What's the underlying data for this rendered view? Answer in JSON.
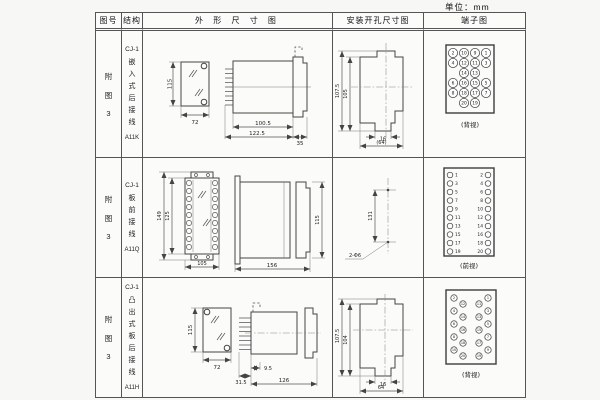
{
  "unit_label": "单位：mm",
  "headers": {
    "figure_no": "图号",
    "structure": "结构",
    "outline": "外 形 尺 寸 图",
    "mounting": "安装开孔尺寸图",
    "terminal": "端子图"
  },
  "rows": [
    {
      "figure_chars": [
        "附",
        "图",
        "3"
      ],
      "model": "CJ-1",
      "type_chars": [
        "嵌",
        "入",
        "式",
        "后",
        "接",
        "线"
      ],
      "code": "A11K",
      "outline": {
        "front_h": "115",
        "front_w": "72",
        "side_l1": "100.5",
        "side_l2": "122.5",
        "side_d": "35"
      },
      "mounting": {
        "outer_h": "107.5",
        "inner_h": "105",
        "slot_w": "16",
        "outer_w": "(64)"
      },
      "terminal_view": "(背视)"
    },
    {
      "figure_chars": [
        "附",
        "图",
        "3"
      ],
      "model": "CJ-1",
      "type_chars": [
        "板",
        "前",
        "接",
        "线"
      ],
      "code": "A11Q",
      "outline": {
        "front_h": "149",
        "front_h2": "125",
        "front_w": "105",
        "side_l": "156",
        "side_h": "115"
      },
      "mounting": {
        "hole_dist": "131",
        "hole_label": "2-Φ6"
      },
      "terminal_view": "(前视)"
    },
    {
      "figure_chars": [
        "附",
        "图",
        "3"
      ],
      "model": "CJ-1",
      "type_chars": [
        "凸",
        "出",
        "式",
        "板",
        "后",
        "接",
        "线"
      ],
      "code": "A11H",
      "outline": {
        "front_h": "115",
        "front_w": "72",
        "pin_len": "31.5",
        "offset": "9.5",
        "side_l": "126"
      },
      "mounting": {
        "outer_h": "107.5",
        "inner_h": "104",
        "slot_w": "16",
        "outer_w": "64"
      },
      "terminal_view": "(背视)"
    }
  ],
  "terminals": {
    "a11k_rows": [
      [
        "2",
        "10",
        "9",
        "1"
      ],
      [
        "4",
        "12",
        "11",
        "3"
      ],
      [
        "14",
        "13"
      ],
      [
        "6",
        "16",
        "15",
        "5"
      ],
      [
        "8",
        "18",
        "17",
        "7"
      ],
      [
        "20",
        "19"
      ]
    ],
    "a11q_left": [
      "1",
      "3",
      "5",
      "7",
      "9",
      "11",
      "13",
      "15",
      "17",
      "19"
    ],
    "a11q_right": [
      "2",
      "4",
      "6",
      "8",
      "10",
      "12",
      "14",
      "16",
      "18",
      "20"
    ],
    "a11h_left_outer": [
      "2",
      "4",
      "6",
      "8",
      "10"
    ],
    "a11h_left_inner": [
      "12",
      "14",
      "16",
      "18",
      "20"
    ],
    "a11h_right_inner": [
      "11",
      "13",
      "15",
      "17",
      "19"
    ],
    "a11h_right_outer": [
      "1",
      "3",
      "5",
      "7",
      "9"
    ]
  }
}
